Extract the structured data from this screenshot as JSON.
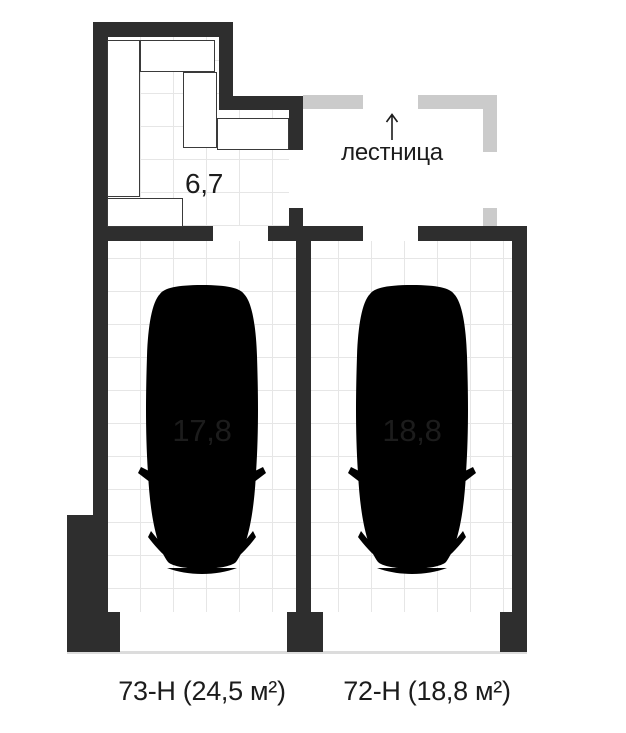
{
  "colors": {
    "wall": "#2e2e2e",
    "wall_light": "#cbcbcb",
    "grid": "#e6e6e6",
    "floor": "#ffffff",
    "car_stroke": "#565656",
    "text": "#1c1c1c",
    "threshold": "#dcdcdc"
  },
  "plan": {
    "utility_room": {
      "area": "6,7"
    },
    "staircase": {
      "label": "лестница",
      "direction_icon": "arrow-up"
    },
    "parking_spaces": [
      {
        "id": "left",
        "area": "17,8",
        "unit": "73-Н (24,5 м²)"
      },
      {
        "id": "right",
        "area": "18,8",
        "unit": "72-Н  (18,8 м²)"
      }
    ]
  }
}
